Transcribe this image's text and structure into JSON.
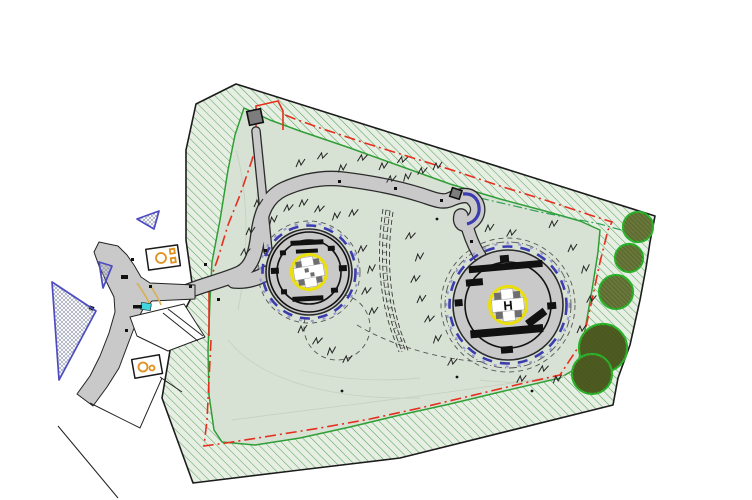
{
  "drawing": {
    "type": "heliport-landscape-site-plan",
    "description": "CAD style site plan: two circular helicopter landing pads with yellow TLOF rings and white cross markings, looped access road, planted boundary band with hatching, red dash-dot site boundary, tree circles along east edge, off-site road junction and buildings to the west"
  },
  "markings": {
    "east_helipad_letter": "H"
  },
  "features": [
    "site-boundary-hatch-band",
    "site-interior-grass",
    "red-boundary-line",
    "green-offset-line",
    "internal-loop-road",
    "footpath-to-structure",
    "west-helipad",
    "east-helipad",
    "helipad-yellow-ring-icon",
    "helipad-cross-icon",
    "blue-edge-marking",
    "turning-head-hook",
    "earth-bund-dashed",
    "grass-tuft-icon",
    "tree-icon",
    "access-road-junction",
    "building-footprint",
    "orange-tank-icon",
    "cyan-marker",
    "blue-hatched-triangle",
    "contour-lines"
  ],
  "colors": {
    "background": "#ffffff",
    "band_fill": "#e7efe4",
    "band_hatch": "#59a459",
    "boundary_line": "#1c1c1c",
    "inner_edge": "#2f9e36",
    "site_fill": "#d8e2d4",
    "contour": "#c4d1c0",
    "road_fill": "#c9c9c9",
    "road_edge": "#2b2b2b",
    "structure_fill": "#7d7d7d",
    "red_boundary": "#e62e1e",
    "green_dashdot": "#33a055",
    "blue_marking": "#3c3cae",
    "blue_marking_light": "#9a9ad0",
    "yellow_ring": "#eadf0c",
    "pad_marking": "#111111",
    "tree_fill": "#68763a",
    "tree_fill_dark": "#4d5a20",
    "tree_hatch": "#46521f",
    "tree_outline": "#2bb32b",
    "triangle_outline": "#4c4cc0",
    "triangle_hatch": "#8d93a8",
    "building_accent": "#e0901e",
    "cyan_marker": "#3fd6df",
    "tan_marking": "#d9b054",
    "dashed_guide": "#555555"
  }
}
